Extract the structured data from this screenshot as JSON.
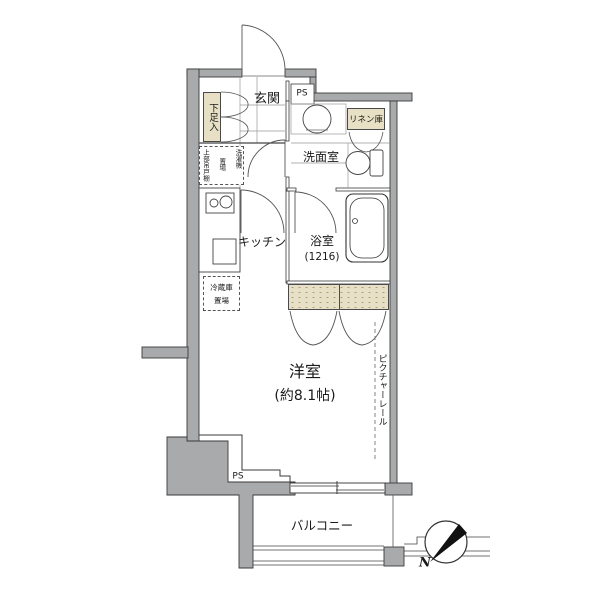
{
  "title": "apartment-floor-plan",
  "colors": {
    "wall_fill": "#a9aaac",
    "accent_beige": "#e8e0c4",
    "closet_beige": "#e7e0c6",
    "line": "#333333"
  },
  "rooms": {
    "entrance": {
      "label": "玄関"
    },
    "washroom": {
      "label": "洗面室"
    },
    "bathroom": {
      "label": "浴室",
      "size": "(1216)"
    },
    "kitchen": {
      "label": "キッチン"
    },
    "living": {
      "label": "洋室",
      "size": "(約8.1帖)"
    },
    "balcony": {
      "label": "バルコニー"
    }
  },
  "storage": {
    "shoe": {
      "label": "下足入"
    },
    "linen": {
      "label": "リネン庫"
    },
    "upper_cabinet": {
      "label": "上部吊戸棚"
    },
    "washer": {
      "col_right": "洗濯機",
      "col_left": "置場"
    },
    "fridge": {
      "line1": "冷蔵庫",
      "line2": "置場"
    }
  },
  "features": {
    "ps_top": "PS",
    "ps_bottom": "PS",
    "picture_rail": "ピクチャーレール",
    "compass_north": "N"
  }
}
